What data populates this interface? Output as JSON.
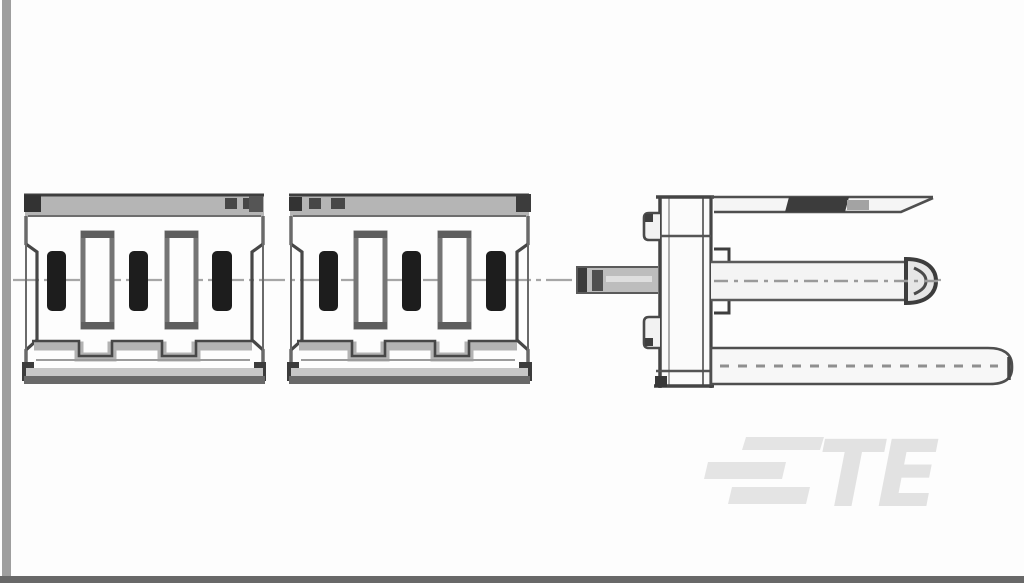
{
  "window": {
    "background_color": "#fdfdfd",
    "left_edge_strip_color": "#9e9e9e",
    "bottom_bar_color": "#686868"
  },
  "drawing": {
    "description": "Monochrome technical line drawing of an electrical pin-header connector: broken-out front view in two segments plus right-side profile view",
    "line_color": "#4a4a4a",
    "shading_color": "#b5b5b5",
    "contact_color": "#1d1d1d",
    "centerline_color": "#a6a6a6",
    "front_view": {
      "segment_count": 2,
      "filled_contacts_per_segment": 3,
      "open_slots_per_segment": 2
    },
    "side_view": {
      "parts": [
        "rear-solder-tail",
        "housing-body",
        "upper-retention-blade",
        "center-contact-pin",
        "lower-mounting-rail"
      ]
    }
  },
  "watermark": {
    "logo_text": "TE",
    "logo_color": "#e3e3e3"
  }
}
